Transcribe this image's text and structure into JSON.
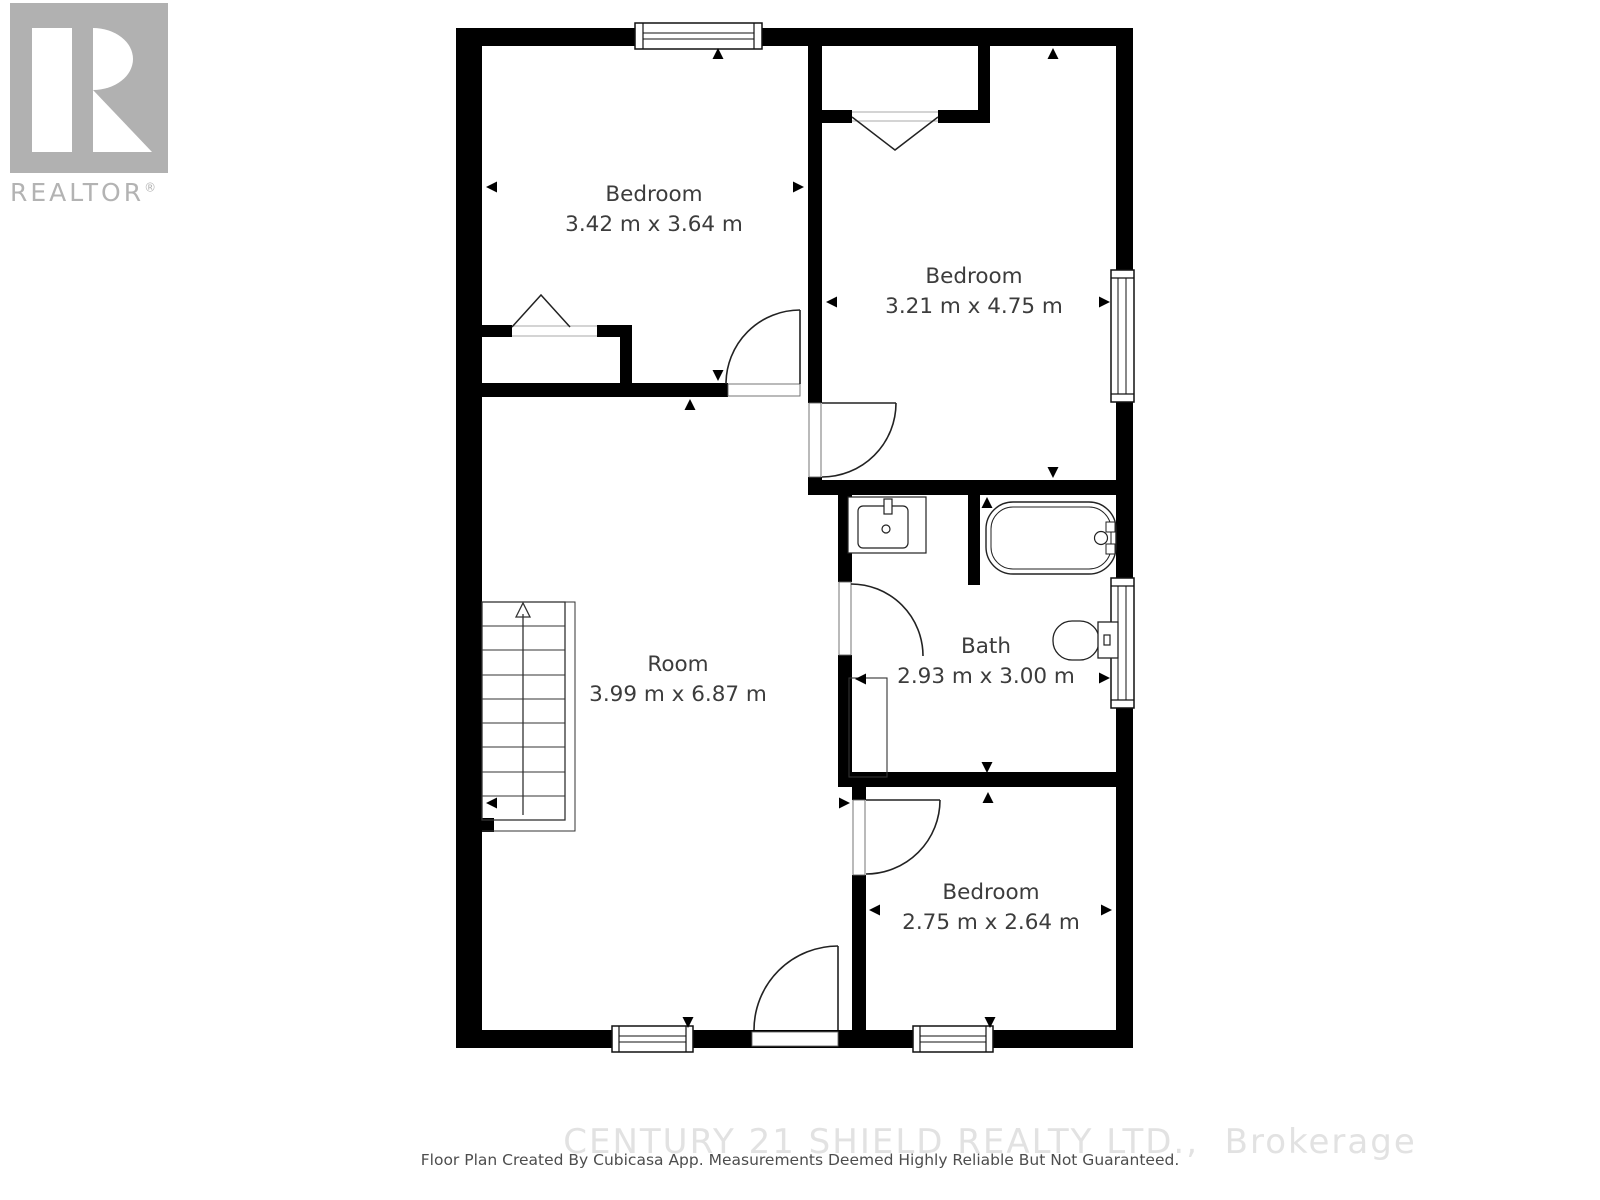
{
  "branding": {
    "logo_name": "REALTOR",
    "registered_symbol": "®"
  },
  "rooms": [
    {
      "id": "bedroom-1",
      "name": "Bedroom",
      "dimensions": "3.42 m x 3.64 m"
    },
    {
      "id": "bedroom-2",
      "name": "Bedroom",
      "dimensions": "3.21 m x 4.75 m"
    },
    {
      "id": "room",
      "name": "Room",
      "dimensions": "3.99 m x 6.87 m"
    },
    {
      "id": "bath",
      "name": "Bath",
      "dimensions": "2.93 m x 3.00 m"
    },
    {
      "id": "bedroom-3",
      "name": "Bedroom",
      "dimensions": "2.75 m x 2.64 m"
    }
  ],
  "footer": {
    "brokerage": "CENTURY 21 SHIELD REALTY LTD.,  Brokerage",
    "disclaimer": "Floor Plan Created By Cubicasa App. Measurements Deemed Highly Reliable But Not Guaranteed."
  },
  "colors": {
    "wall": "#000000",
    "thin_line": "#222222",
    "label_text": "#3c3c3c",
    "logo_gray": "#b1b1b1",
    "watermark": "#e2e2e2",
    "disclaimer_text": "#4d4d4d"
  }
}
